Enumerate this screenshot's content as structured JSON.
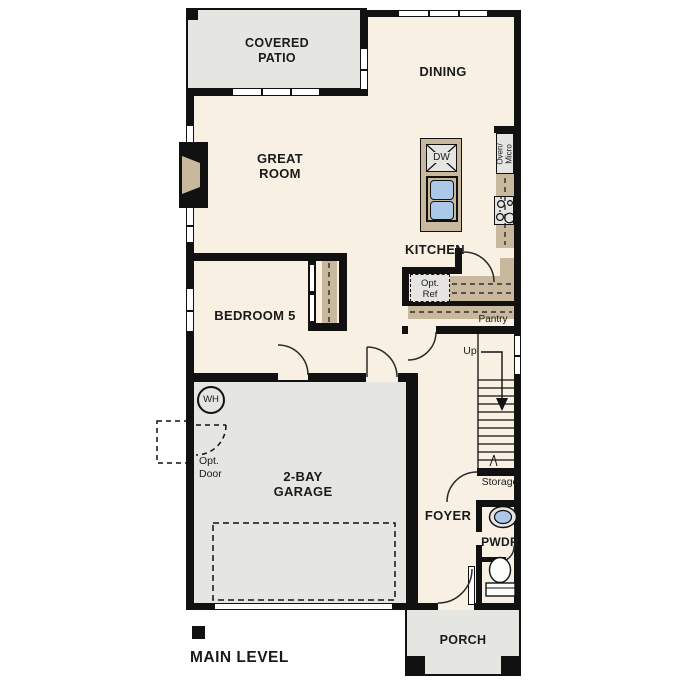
{
  "plan": {
    "rooms": {
      "covered_patio_line1": "COVERED",
      "covered_patio_line2": "PATIO",
      "dining": "DINING",
      "great_room_line1": "GREAT",
      "great_room_line2": "ROOM",
      "kitchen": "KITCHEN",
      "bedroom5": "BEDROOM 5",
      "garage_line1": "2-BAY",
      "garage_line2": "GARAGE",
      "foyer": "FOYER",
      "pwdr": "PWDR",
      "porch": "PORCH",
      "pantry": "Pantry",
      "storage": "Storage"
    },
    "annotations": {
      "up": "Up",
      "wh": "WH",
      "dw": "DW",
      "oven_micro_line1": "Oven/",
      "oven_micro_line2": "Micro",
      "opt_ref_line1": "Opt.",
      "opt_ref_line2": "Ref",
      "opt_door_line1": "Opt.",
      "opt_door_line2": "Door"
    },
    "footer": {
      "level_label": "MAIN LEVEL"
    },
    "colors": {
      "floor": "#f8f0e3",
      "hardscape": "#e5e5e2",
      "counter_tan": "#c8b99e",
      "fixture_gray": "#e6e5e2",
      "sink_blue": "#abc8e8",
      "wall": "#111111"
    }
  }
}
